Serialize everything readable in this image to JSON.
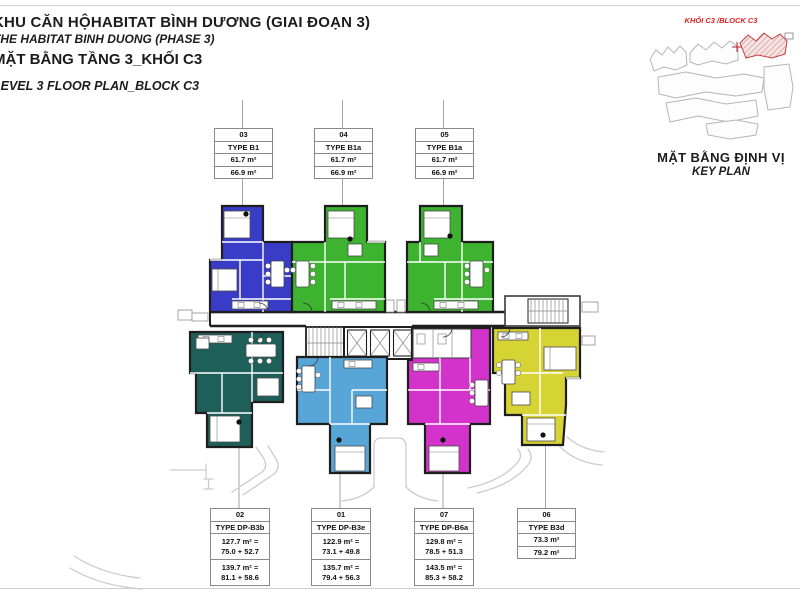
{
  "titles": {
    "project_vi": "KHU CĂN HỘHABITAT BÌNH DƯƠNG (GIAI ĐOẠN 3)",
    "project_en": "THE HABITAT BINH DUONG (PHASE 3)",
    "plan_vi": "MẶT BẰNG TẦNG 3_KHỐI C3",
    "plan_en": "LEVEL 3 FLOOR PLAN_BLOCK C3"
  },
  "key_plan": {
    "block_label": "KHỐI C3 /BLOCK C3",
    "caption_vi": "MẶT BẰNG ĐỊNH VỊ",
    "caption_en": "KEY PLAN"
  },
  "units": {
    "u03": {
      "id": "03",
      "type": "TYPE B1",
      "area_net": "61.7 m²",
      "area_gross": "66.9 m²",
      "color": "#383cc6"
    },
    "u04": {
      "id": "04",
      "type": "TYPE B1a",
      "area_net": "61.7 m²",
      "area_gross": "66.9 m²",
      "color": "#3db32f"
    },
    "u05": {
      "id": "05",
      "type": "TYPE B1a",
      "area_net": "61.7 m²",
      "area_gross": "66.9 m²",
      "color": "#3db32f"
    },
    "u02": {
      "id": "02",
      "type": "TYPE DP-B3b",
      "area1": "127.7 m² =",
      "area1b": "75.0 + 52.7",
      "area2": "139.7 m² =",
      "area2b": "81.1 + 58.6",
      "color": "#1e5f5a"
    },
    "u01": {
      "id": "01",
      "type": "TYPE DP-B3e",
      "area1": "122.9 m² =",
      "area1b": "73.1 + 49.8",
      "area2": "135.7 m² =",
      "area2b": "79.4 + 56.3",
      "color": "#58a5d8"
    },
    "u07": {
      "id": "07",
      "type": "TYPE DP-B6a",
      "area1": "129.8 m² =",
      "area1b": "78.5 + 51.3",
      "area2": "143.5 m² =",
      "area2b": "85.3 + 58.2",
      "color": "#d433cb"
    },
    "u06": {
      "id": "06",
      "type": "TYPE B3d",
      "area_net": "73.3 m²",
      "area_gross": "79.2 m²",
      "color": "#d6d334"
    }
  },
  "colors": {
    "accent_red": "#e02020",
    "wall": "#1e1e1e",
    "leader": "#9a9a9a",
    "landscape": "#cccccc"
  }
}
